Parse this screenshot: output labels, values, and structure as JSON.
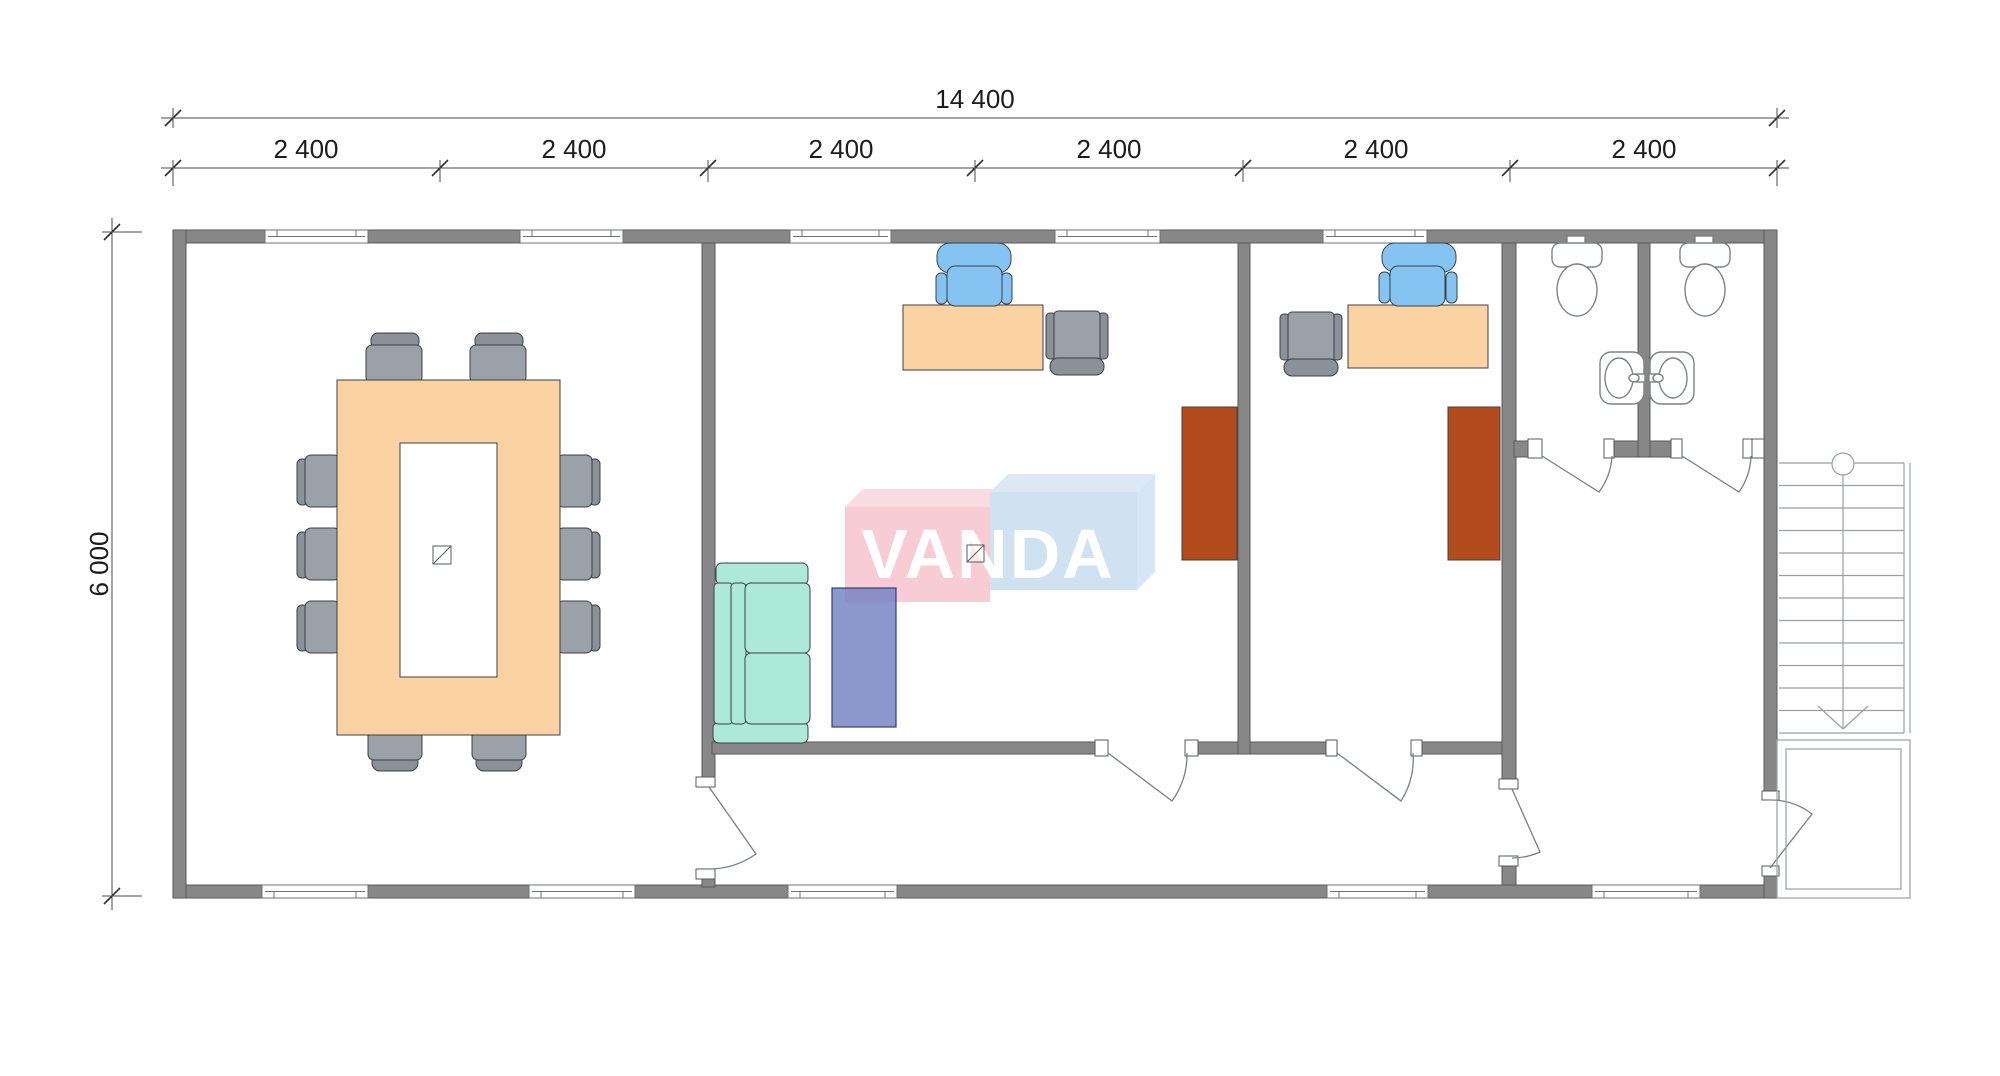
{
  "dimensions": {
    "total_width_label": "14 400",
    "segment_labels": [
      "2 400",
      "2 400",
      "2 400",
      "2 400",
      "2 400",
      "2 400"
    ],
    "height_label": "6 000"
  },
  "watermark": {
    "text": "VANDA",
    "pink": "#f7ccd5",
    "blue": "#cfe2f2"
  },
  "colors": {
    "wall": "#878787",
    "wood": "#fbd2a2",
    "chair_gray": "#9ba1a8",
    "chair_gray_back": "#8b9198",
    "chair_blue": "#85c3f2",
    "sofa_teal": "#ace9d8",
    "rug_purple": "#7381c1",
    "cabinet_rust": "#b44b1d"
  },
  "furniture_icons": [
    "conference-table",
    "conference-chair",
    "office-desk",
    "office-chair",
    "visitor-chair",
    "wardrobe-cabinet",
    "sofa",
    "rug",
    "toilet",
    "sink",
    "staircase"
  ]
}
